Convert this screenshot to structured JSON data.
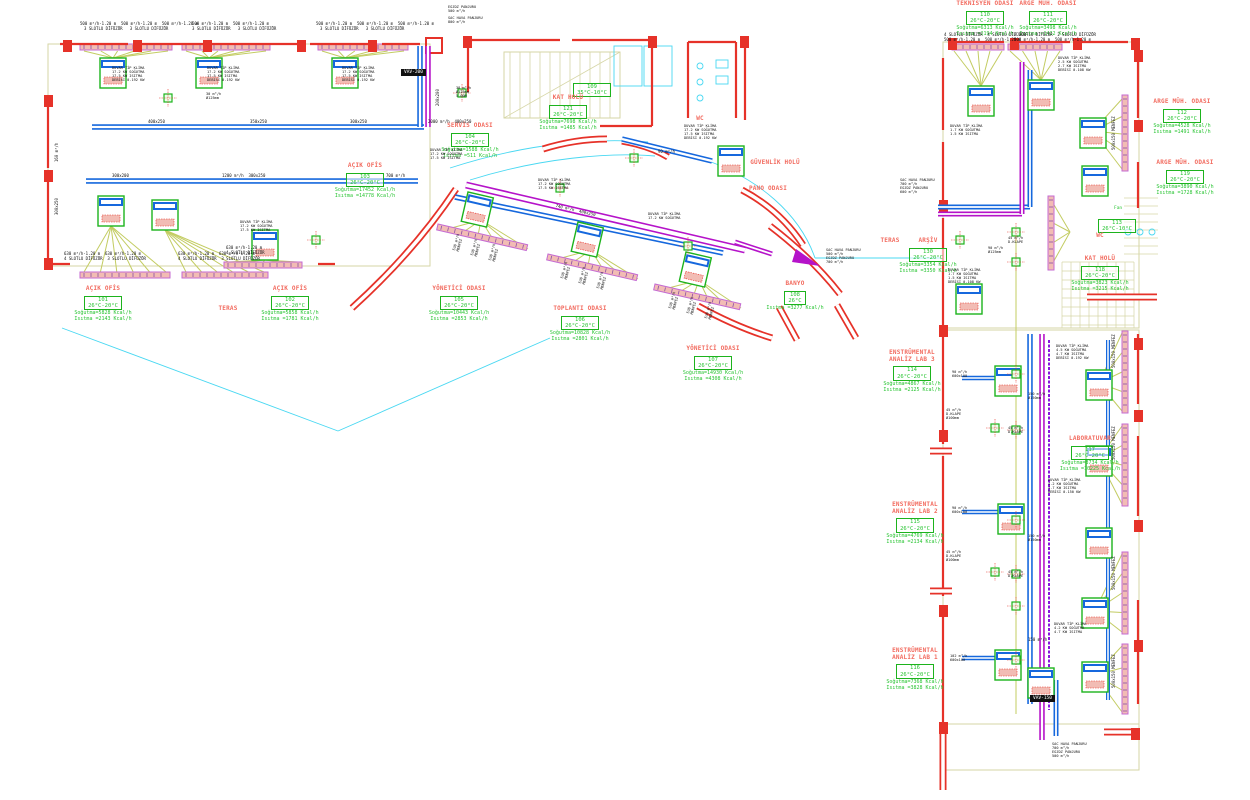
{
  "drawing": {
    "title": "HVAC kat planı – klima ve havalandırma tesisatı",
    "units": "Kcal/h, m³/h"
  },
  "colors": {
    "wall_red": "#e63229",
    "duct_blue": "#1668dd",
    "duct_magenta": "#b513c9",
    "duct_purple": "#8a14e0",
    "unit_green": "#1db31d",
    "line_olive": "#c3cc62",
    "line_khaki": "#d6d6a6",
    "line_cyan": "#49d8f2",
    "fill_pink": "#f2bcb4",
    "strip_violet": "#c46ad2",
    "text_red": "#f26a5e",
    "text_green": "#28c432",
    "text_black": "#111111"
  },
  "rooms": [
    {
      "name": "AÇIK OFİS",
      "number": "101",
      "temp": "26°C-20°C",
      "cooling": "Soğutma=5828 Kcal/h",
      "heating": "Isıtma =2143 Kcal/h",
      "x": 60,
      "y": 286
    },
    {
      "name": "AÇIK OFİS",
      "number": "102",
      "temp": "26°C-20°C",
      "cooling": "Soğutma=5858 Kcal/h",
      "heating": "Isıtma =1781 Kcal/h",
      "x": 247,
      "y": 286
    },
    {
      "name": "AÇIK OFİS",
      "number": "103",
      "temp": "26°C-20°C",
      "cooling": "Soğutma=17452 Kcal/h",
      "heating": "Isıtma =14778 Kcal/h",
      "x": 322,
      "y": 163
    },
    {
      "name": "SERVİS ODASI",
      "number": "104",
      "temp": "26°C-20°C",
      "cooling": "Soğutma=1588 Kcal/h",
      "heating": "Isıtma =511 Kcal/h",
      "x": 427,
      "y": 123
    },
    {
      "name": "YÖNETİCİ ODASI",
      "number": "105",
      "temp": "26°C-20°C",
      "cooling": "Soğutma=10443 Kcal/h",
      "heating": "Isıtma =2853 Kcal/h",
      "x": 416,
      "y": 286
    },
    {
      "name": "TOPLANTI ODASI",
      "number": "106",
      "temp": "26°C-20°C",
      "cooling": "Soğutma=10828 Kcal/h",
      "heating": "Isıtma =2801 Kcal/h",
      "x": 537,
      "y": 306
    },
    {
      "name": "YÖNETİCİ ODASI",
      "number": "107",
      "temp": "26°C-20°C",
      "cooling": "Soğutma=14930 Kcal/h",
      "heating": "Isıtma =4308 Kcal/h",
      "x": 670,
      "y": 346
    },
    {
      "name": "BANYO",
      "number": "108",
      "temp": "26°C",
      "cooling": "",
      "heating": "Isıtma =3277 Kcal/h",
      "x": 752,
      "y": 281
    },
    {
      "name": "",
      "number": "109",
      "temp": "35°C-10°C",
      "cooling": "",
      "heating": "",
      "x": 549,
      "y": 80
    },
    {
      "name": "KAT HOLÜ",
      "number": "121",
      "temp": "26°C-20°C",
      "cooling": "Soğutma=7698 Kcal/h",
      "heating": "Isıtma =1485 Kcal/h",
      "x": 525,
      "y": 95
    },
    {
      "name": "WC",
      "number": "",
      "temp": "",
      "cooling": "",
      "heating": "",
      "x": 657,
      "y": 116
    },
    {
      "name": "GÜVENLİK HOLÜ",
      "number": "",
      "temp": "",
      "cooling": "",
      "heating": "",
      "x": 732,
      "y": 160
    },
    {
      "name": "PANO ODASI",
      "number": "",
      "temp": "",
      "cooling": "",
      "heating": "",
      "x": 725,
      "y": 186
    },
    {
      "name": "TERAS",
      "number": "",
      "temp": "",
      "cooling": "",
      "heating": "",
      "x": 185,
      "y": 306
    },
    {
      "name": "TERAS",
      "number": "",
      "temp": "",
      "cooling": "",
      "heating": "",
      "x": 847,
      "y": 238
    },
    {
      "name": "TEKNİSYEN ODASI",
      "number": "110",
      "temp": "26°C-20°C",
      "cooling": "Soğutma=6313 Kcal/h",
      "heating": "Isıtma =2194 Kcal/h",
      "x": 942,
      "y": 1
    },
    {
      "name": "ARGE MÜH. ODASI",
      "number": "111",
      "temp": "26°C-20°C",
      "cooling": "Soğutma=3498 Kcal/h",
      "heating": "Isıtma =1432 Kcal/h",
      "x": 1005,
      "y": 1
    },
    {
      "name": "ARGE MÜH. ODASI",
      "number": "112",
      "temp": "26°C-20°C",
      "cooling": "Soğutma=4528 Kcal/h",
      "heating": "Isıtma =1491 Kcal/h",
      "x": 1139,
      "y": 99
    },
    {
      "name": "ARGE MÜH. ODASI",
      "number": "119",
      "temp": "26°C-20°C",
      "cooling": "Soğutma=3890 Kcal/h",
      "heating": "Isıtma =1728 Kcal/h",
      "x": 1142,
      "y": 160
    },
    {
      "name": "",
      "number": "113",
      "temp": "26°C-10°C",
      "cooling": "",
      "heating": "",
      "x": 1074,
      "y": 216
    },
    {
      "name": "WC",
      "number": "",
      "temp": "",
      "cooling": "",
      "heating": "",
      "x": 1057,
      "y": 233
    },
    {
      "name": "KAT HOLÜ",
      "number": "118",
      "temp": "26°C-20°C",
      "cooling": "Soğutma=3823 Kcal/h",
      "heating": "Isıtma =3215 Kcal/h",
      "x": 1057,
      "y": 256
    },
    {
      "name": "ARŞİV",
      "number": "130",
      "temp": "26°C-20°C",
      "cooling": "Soğutma=3354 Kcal/h",
      "heating": "Isıtma =3350 Kcal/h",
      "x": 885,
      "y": 238
    },
    {
      "name": "ENSTRÜMENTAL\nANALİZ LAB 3",
      "number": "114",
      "temp": "26°C-20°C",
      "cooling": "Soğutma=4867 Kcal/h",
      "heating": "Isıtma =2125 Kcal/h",
      "x": 869,
      "y": 350
    },
    {
      "name": "LABORATUVAR",
      "number": "117",
      "temp": "26°C-20°C",
      "cooling": "Soğutma=3734 Kcal/h",
      "heating": "Isıtma =10225 Kcal/h",
      "x": 1047,
      "y": 436
    },
    {
      "name": "ENSTRÜMENTAL\nANALİZ LAB 2",
      "number": "115",
      "temp": "26°C-20°C",
      "cooling": "Soğutma=4769 Kcal/h",
      "heating": "Isıtma =2134 Kcal/h",
      "x": 872,
      "y": 502
    },
    {
      "name": "ENSTRÜMENTAL\nANALİZ LAB 1",
      "number": "116",
      "temp": "26°C-20°C",
      "cooling": "Soğutma=7368 Kcal/h",
      "heating": "Isıtma =3828 Kcal/h",
      "x": 872,
      "y": 648
    }
  ],
  "annotations": [
    {
      "t": "500 m³/h-1.20 m  500 m³/h-1.20 m  500 m³/h-1.20 m",
      "x": 80,
      "y": 22
    },
    {
      "t": "3 SLOTLU DİFÜZÖR   3 SLOTLU DİFÜZÖR",
      "x": 84,
      "y": 27
    },
    {
      "t": "500 m³/h-1.20 m  500 m³/h-1.20 m",
      "x": 192,
      "y": 22
    },
    {
      "t": "3 SLOTLU DİFÜZÖR   3 SLOTLU DİFÜZÖR",
      "x": 192,
      "y": 27
    },
    {
      "t": "500 m³/h-1.20 m  500 m³/h-1.20 m  500 m³/h-1.20 m",
      "x": 316,
      "y": 22
    },
    {
      "t": "3 SLOTLU DİFÜZÖR   3 SLOTLU DİFÜZÖR",
      "x": 320,
      "y": 27
    },
    {
      "t": "DUVAR TİP KLİMA\n17.2 KW SOĞUTMA\n17.5 KW ISITMA\nDEBİSİ 0.192 KW",
      "x": 112,
      "y": 66,
      "cls": "kb"
    },
    {
      "t": "DUVAR TİP KLİMA\n17.2 KW SOĞUTMA\n17.5 KW ISITMA\nDEBİSİ 0.192 KW",
      "x": 207,
      "y": 66,
      "cls": "kb"
    },
    {
      "t": "DUVAR TİP KLİMA\n17.2 KW SOĞUTMA\n17.5 KW ISITMA\nDEBİSİ 0.192 KW",
      "x": 342,
      "y": 66,
      "cls": "kb"
    },
    {
      "t": "400x250",
      "x": 148,
      "y": 120
    },
    {
      "t": "350x250",
      "x": 250,
      "y": 120
    },
    {
      "t": "300x250",
      "x": 350,
      "y": 120
    },
    {
      "t": "300x200",
      "x": 112,
      "y": 174
    },
    {
      "t": "1200 m³/h  300x250",
      "x": 222,
      "y": 174
    },
    {
      "t": "700 m³/h",
      "x": 386,
      "y": 174
    },
    {
      "t": "160 m³/h",
      "x": 55,
      "y": 162,
      "rot": -90
    },
    {
      "t": "300x250",
      "x": 55,
      "y": 215,
      "rot": -90
    },
    {
      "t": "EGZOZ PANJURU\n500 m³/h",
      "x": 448,
      "y": 5,
      "cls": "kb"
    },
    {
      "t": "SAC HAVA PANJURU\n800 m³/h",
      "x": 448,
      "y": 16,
      "cls": "kb"
    },
    {
      "t": "VAV-200",
      "x": 401,
      "y": 69,
      "cls": "vav"
    },
    {
      "t": "200x200",
      "x": 436,
      "y": 106,
      "rot": -90
    },
    {
      "t": "2000 m³/h  400x250",
      "x": 428,
      "y": 120
    },
    {
      "t": "38 m³/h\nØ125mm\n5.00M",
      "x": 456,
      "y": 86,
      "cls": "kb"
    },
    {
      "t": "630 m³/h-1.20 m  630 m³/h-1.20 m",
      "x": 64,
      "y": 252
    },
    {
      "t": "4 SLOTLU DİFÜZÖR  3 SLOTLU DİFÜZÖR",
      "x": 64,
      "y": 257
    },
    {
      "t": "630 m³/h-1.20 m  630 m³/h-1.20 m",
      "x": 178,
      "y": 252
    },
    {
      "t": "4 SLOTLU DİFÜZÖR  3 SLOTLU DİFÜZÖR",
      "x": 178,
      "y": 257
    },
    {
      "t": "630 m³/h-1.20 m",
      "x": 226,
      "y": 246
    },
    {
      "t": "4 SLOTLU DİFÜZÖR",
      "x": 226,
      "y": 251
    },
    {
      "t": "DUVAR TİP KLİMA\n17.2 KW SOĞUTMA\n17.5 KW ISITMA",
      "x": 240,
      "y": 220,
      "cls": "kb"
    },
    {
      "t": "30 m³/h\nØ125mm",
      "x": 206,
      "y": 92,
      "cls": "kb"
    },
    {
      "t": "DUVAR TİP KLİMA\n17.2 KW SOĞUTMA\n17.5 KW ISITMA",
      "x": 430,
      "y": 148,
      "cls": "kb"
    },
    {
      "t": "740 m³/h  400x250",
      "x": 556,
      "y": 204,
      "rot": 13
    },
    {
      "t": "530 m³/h\nMENFEZ",
      "x": 452,
      "y": 250,
      "rot": -75,
      "cls": "kb"
    },
    {
      "t": "530 m³/h\nMENFEZ",
      "x": 470,
      "y": 255,
      "rot": -75,
      "cls": "kb"
    },
    {
      "t": "530 m³/h\nMENFEZ",
      "x": 488,
      "y": 260,
      "rot": -75,
      "cls": "kb"
    },
    {
      "t": "530 m³/h\nMENFEZ",
      "x": 560,
      "y": 278,
      "rot": -75,
      "cls": "kb"
    },
    {
      "t": "530 m³/h\nMENFEZ",
      "x": 578,
      "y": 283,
      "rot": -75,
      "cls": "kb"
    },
    {
      "t": "530 m³/h\nMENFEZ",
      "x": 596,
      "y": 288,
      "rot": -75,
      "cls": "kb"
    },
    {
      "t": "530 m³/h\nMENFEZ",
      "x": 668,
      "y": 308,
      "rot": -75,
      "cls": "kb"
    },
    {
      "t": "530 m³/h\nMENFEZ",
      "x": 686,
      "y": 313,
      "rot": -75,
      "cls": "kb"
    },
    {
      "t": "530 m³/h\nMENFEZ",
      "x": 704,
      "y": 318,
      "rot": -75,
      "cls": "kb"
    },
    {
      "t": "DUVAR TİP KLİMA\n17.2 KW SOĞUTMA\n17.5 KW ISITMA",
      "x": 538,
      "y": 178,
      "cls": "kb"
    },
    {
      "t": "DUVAR TİP KLİMA\n17.2 KW SOĞUTMA",
      "x": 648,
      "y": 212,
      "cls": "kb"
    },
    {
      "t": "DUVAR TİP KLİMA\n17.2 KW SOĞUTMA\n17.5 KW ISITMA\nDEBİSİ 0.192 KW",
      "x": 684,
      "y": 124,
      "cls": "kb"
    },
    {
      "t": "90 m³/h",
      "x": 658,
      "y": 150
    },
    {
      "t": "SAC HAVA PANJURU\n500 m³/h\nEGZOZ PANJURU\n700 m³/h",
      "x": 826,
      "y": 248,
      "cls": "kb"
    },
    {
      "t": "4 SLOTLU DİFÜZÖR  4 SLOTLU DİFÜZÖR",
      "x": 944,
      "y": 33
    },
    {
      "t": "500 m³/h-1.20 m  500 m³/h-1.20 m",
      "x": 944,
      "y": 38
    },
    {
      "t": "2 SLOTLU DİFÜZÖR  2 SLOTLU DİFÜZÖR",
      "x": 1014,
      "y": 33
    },
    {
      "t": "500 m³/h-1.20 m  500 m³/h-1.20 m",
      "x": 1014,
      "y": 38
    },
    {
      "t": "DUVAR TİP KLİMA\n2.5 KW SOĞUTMA\n2.7 KW ISITMA\nDEBİSİ 0.108 KW",
      "x": 1058,
      "y": 56,
      "cls": "kb"
    },
    {
      "t": "DUVAR TİP KLİMA\n1.7 KW SOĞUTMA\n1.5 KW ISITMA",
      "x": 950,
      "y": 124,
      "cls": "kb"
    },
    {
      "t": "SAC HAVA PANJURU\n700 m³/h\nEGZOZ PANJURU\n600 m³/h",
      "x": 900,
      "y": 178,
      "cls": "kb"
    },
    {
      "t": "Fan",
      "x": 1114,
      "y": 206,
      "cls": "g"
    },
    {
      "t": "90 m³/h\nØ125mm",
      "x": 988,
      "y": 246,
      "cls": "kb"
    },
    {
      "t": "DUVAR TİP KLİMA\n1.7 KW SOĞUTMA\n1.5 KW ISITMA\nDEBİSİ 0.108 KW",
      "x": 948,
      "y": 268,
      "cls": "kb"
    },
    {
      "t": "45 m³/h\nD.KLAPE",
      "x": 1008,
      "y": 236,
      "cls": "kb"
    },
    {
      "t": "90 m³/h\n600x100",
      "x": 952,
      "y": 370,
      "cls": "kb"
    },
    {
      "t": "150 m³/h\nØ150mm",
      "x": 1028,
      "y": 392,
      "cls": "kb"
    },
    {
      "t": "45 m³/h\nD.KLAPE\nØ100mm",
      "x": 946,
      "y": 408,
      "cls": "kb"
    },
    {
      "t": "DUVAR TİP KLİMA\n4.5 KW SOĞUTMA\n4.7 KW ISITMA\nDEBİSİ 0.192 KW",
      "x": 1056,
      "y": 344,
      "cls": "kb"
    },
    {
      "t": "45 m³/h\nD.KLAPE",
      "x": 1008,
      "y": 426,
      "cls": "kb"
    },
    {
      "t": "500x150 MENFEZ",
      "x": 1112,
      "y": 150,
      "rot": -90
    },
    {
      "t": "500x150 MENFEZ",
      "x": 1112,
      "y": 368,
      "rot": -90
    },
    {
      "t": "500x150 MENFEZ",
      "x": 1112,
      "y": 460,
      "rot": -90
    },
    {
      "t": "500x150 MENFEZ",
      "x": 1112,
      "y": 590,
      "rot": -90
    },
    {
      "t": "500x150 MENFEZ",
      "x": 1112,
      "y": 688,
      "rot": -90
    },
    {
      "t": "90 m³/h\n600x100",
      "x": 952,
      "y": 506,
      "cls": "kb"
    },
    {
      "t": "150 m³/h\nØ150mm",
      "x": 1028,
      "y": 534,
      "cls": "kb"
    },
    {
      "t": "DUVAR TİP KLİMA\n4.2 KW SOĞUTMA\n4.7 KW ISITMA\nDEBİSİ 0.150 KW",
      "x": 1048,
      "y": 478,
      "cls": "kb"
    },
    {
      "t": "45 m³/h\nD.KLAPE\nØ100mm",
      "x": 946,
      "y": 550,
      "cls": "kb"
    },
    {
      "t": "45 m³/h\nD.KLAPE",
      "x": 1008,
      "y": 570,
      "cls": "kb"
    },
    {
      "t": "102 m³/h\n600x100",
      "x": 950,
      "y": 654,
      "cls": "kb"
    },
    {
      "t": "150 m³/h",
      "x": 1028,
      "y": 638
    },
    {
      "t": "DUVAR TİP KLİMA\n4.2 KW SOĞUTMA\n4.7 KW ISITMA",
      "x": 1054,
      "y": 622,
      "cls": "kb"
    },
    {
      "t": "VAV-150",
      "x": 1030,
      "y": 695,
      "cls": "vav"
    },
    {
      "t": "SAC HAVA PANJURU\n700 m³/h\nEGZOZ PANJURU\n500 m³/h",
      "x": 1052,
      "y": 742,
      "cls": "kb"
    }
  ]
}
